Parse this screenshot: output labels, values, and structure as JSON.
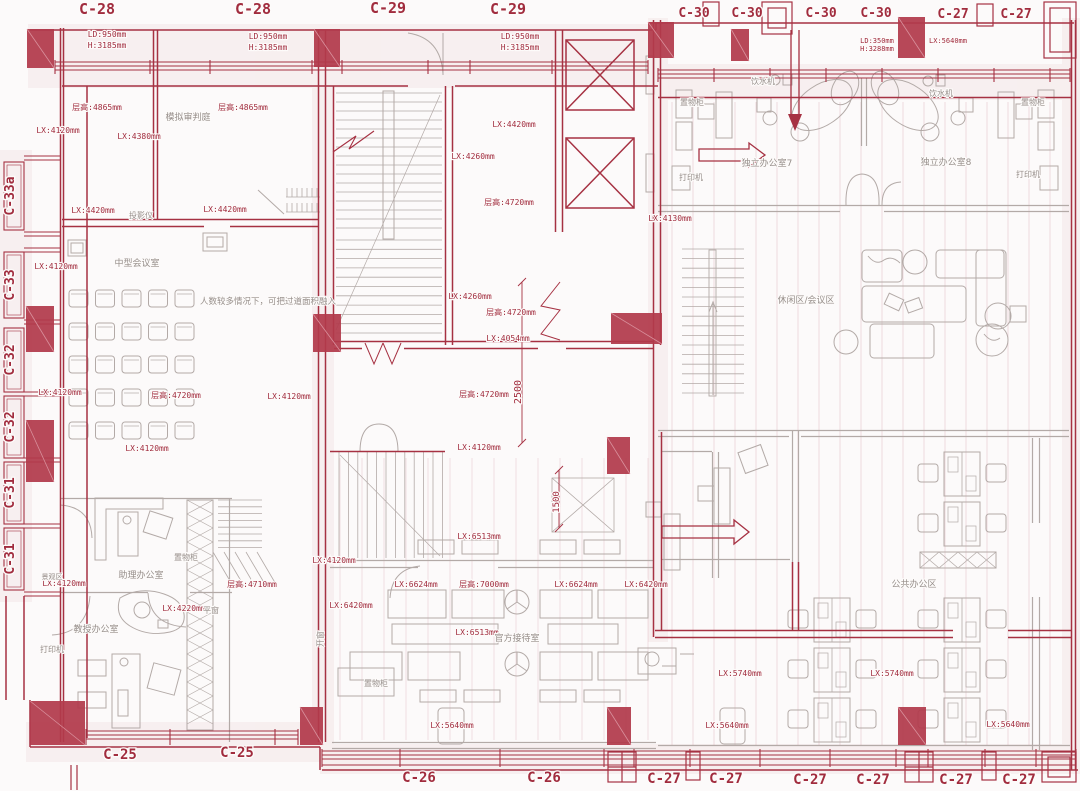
{
  "colors": {
    "wall_red": "#a63142",
    "column_red": "#b23a4b",
    "line_gray": "#b3aaa7",
    "text_gray": "#968e8a",
    "text_red": "#a12c3e",
    "background": "#fcfafa"
  },
  "grid": {
    "top": [
      {
        "label": "C-28",
        "x": 97,
        "y": 14,
        "size": 15
      },
      {
        "label": "C-28",
        "x": 253,
        "y": 14,
        "size": 15
      },
      {
        "label": "C-29",
        "x": 388,
        "y": 13,
        "size": 15
      },
      {
        "label": "C-29",
        "x": 508,
        "y": 14,
        "size": 15
      },
      {
        "label": "C-30",
        "x": 694,
        "y": 17,
        "size": 13
      },
      {
        "label": "C-30",
        "x": 747,
        "y": 17,
        "size": 13
      },
      {
        "label": "C-30",
        "x": 821,
        "y": 17,
        "size": 13
      },
      {
        "label": "C-30",
        "x": 876,
        "y": 17,
        "size": 13
      },
      {
        "label": "C-27",
        "x": 953,
        "y": 18,
        "size": 13
      },
      {
        "label": "C-27",
        "x": 1016,
        "y": 18,
        "size": 13
      }
    ],
    "left": [
      {
        "label": "C-33a",
        "x": 14,
        "y": 196
      },
      {
        "label": "C-33",
        "x": 14,
        "y": 285
      },
      {
        "label": "C-32",
        "x": 14,
        "y": 360
      },
      {
        "label": "C-32",
        "x": 14,
        "y": 427
      },
      {
        "label": "C-31",
        "x": 14,
        "y": 493
      },
      {
        "label": "C-31",
        "x": 14,
        "y": 559
      }
    ],
    "bottom": [
      {
        "label": "C-25",
        "x": 120,
        "y": 759,
        "size": 14
      },
      {
        "label": "C-25",
        "x": 237,
        "y": 757,
        "size": 14
      },
      {
        "label": "C-26",
        "x": 419,
        "y": 782,
        "size": 14
      },
      {
        "label": "C-26",
        "x": 544,
        "y": 782,
        "size": 14
      },
      {
        "label": "C-27",
        "x": 664,
        "y": 783,
        "size": 14
      },
      {
        "label": "C-27",
        "x": 726,
        "y": 783,
        "size": 14
      },
      {
        "label": "C-27",
        "x": 810,
        "y": 784,
        "size": 14
      },
      {
        "label": "C-27",
        "x": 873,
        "y": 784,
        "size": 14
      },
      {
        "label": "C-27",
        "x": 956,
        "y": 784,
        "size": 14
      },
      {
        "label": "C-27",
        "x": 1019,
        "y": 784,
        "size": 14
      }
    ]
  },
  "dimensions": [
    {
      "text": "LD:950mm",
      "x": 107,
      "y": 37
    },
    {
      "text": "H:3185mm",
      "x": 107,
      "y": 48
    },
    {
      "text": "LD:950mm",
      "x": 268,
      "y": 39
    },
    {
      "text": "H:3185mm",
      "x": 268,
      "y": 50
    },
    {
      "text": "LD:950mm",
      "x": 520,
      "y": 39
    },
    {
      "text": "H:3185mm",
      "x": 520,
      "y": 50
    },
    {
      "text": "LD:350mm",
      "x": 877,
      "y": 43,
      "size": 7
    },
    {
      "text": "H:3288mm",
      "x": 877,
      "y": 51,
      "size": 7
    },
    {
      "text": "LX:5640mm",
      "x": 948,
      "y": 43,
      "size": 7
    },
    {
      "text": "层高:4865mm",
      "x": 97,
      "y": 110
    },
    {
      "text": "层高:4865mm",
      "x": 243,
      "y": 110
    },
    {
      "text": "LX:4120mm",
      "x": 58,
      "y": 133
    },
    {
      "text": "LX:4380mm",
      "x": 139,
      "y": 139
    },
    {
      "text": "LX:4420mm",
      "x": 93,
      "y": 213
    },
    {
      "text": "LX:4420mm",
      "x": 225,
      "y": 212
    },
    {
      "text": "LX:4420mm",
      "x": 514,
      "y": 127
    },
    {
      "text": "LX:4260mm",
      "x": 473,
      "y": 159
    },
    {
      "text": "层高:4720mm",
      "x": 509,
      "y": 205
    },
    {
      "text": "LX:4130mm",
      "x": 670,
      "y": 221
    },
    {
      "text": "LX:4120mm",
      "x": 56,
      "y": 269
    },
    {
      "text": "LX:4260mm",
      "x": 470,
      "y": 299
    },
    {
      "text": "层高:4720mm",
      "x": 511,
      "y": 315
    },
    {
      "text": "LX:4054mm",
      "x": 508,
      "y": 341
    },
    {
      "text": "LX:4120mm",
      "x": 60,
      "y": 395
    },
    {
      "text": "层高:4720mm",
      "x": 176,
      "y": 398
    },
    {
      "text": "LX:4120mm",
      "x": 289,
      "y": 399
    },
    {
      "text": "层高:4720mm",
      "x": 484,
      "y": 397
    },
    {
      "text": "LX:4120mm",
      "x": 147,
      "y": 451
    },
    {
      "text": "LX:4120mm",
      "x": 479,
      "y": 450
    },
    {
      "text": "LX:6513mm",
      "x": 479,
      "y": 539
    },
    {
      "text": "LX:4120mm",
      "x": 64,
      "y": 586
    },
    {
      "text": "层高:4710mm",
      "x": 252,
      "y": 587
    },
    {
      "text": "LX:4220mm",
      "x": 184,
      "y": 611
    },
    {
      "text": "LX:4120mm",
      "x": 334,
      "y": 563
    },
    {
      "text": "LX:6624mm",
      "x": 416,
      "y": 587
    },
    {
      "text": "层高:7000mm",
      "x": 484,
      "y": 587
    },
    {
      "text": "LX:6624mm",
      "x": 576,
      "y": 587
    },
    {
      "text": "LX:6420mm",
      "x": 646,
      "y": 587
    },
    {
      "text": "LX:6420mm",
      "x": 351,
      "y": 608
    },
    {
      "text": "LX:6513mm",
      "x": 477,
      "y": 635
    },
    {
      "text": "LX:5740mm",
      "x": 740,
      "y": 676
    },
    {
      "text": "LX:5740mm",
      "x": 892,
      "y": 676
    },
    {
      "text": "LX:5640mm",
      "x": 452,
      "y": 728
    },
    {
      "text": "LX:5640mm",
      "x": 727,
      "y": 728
    },
    {
      "text": "LX:5640mm",
      "x": 1008,
      "y": 727
    },
    {
      "text": "2500",
      "x": 521,
      "y": 392,
      "rot": -90,
      "size": 10
    },
    {
      "text": "1500",
      "x": 559,
      "y": 502,
      "rot": -90,
      "size": 9
    }
  ],
  "rooms": [
    {
      "text": "模拟审判庭",
      "x": 188,
      "y": 120
    },
    {
      "text": "投影仪",
      "x": 141,
      "y": 218,
      "size": 8
    },
    {
      "text": "中型会议室",
      "x": 137,
      "y": 266
    },
    {
      "text": "人数较多情况下，可把过道面积融入",
      "x": 268,
      "y": 304,
      "size": 8.5
    },
    {
      "text": "饮水机",
      "x": 763,
      "y": 84,
      "size": 8
    },
    {
      "text": "饮水机",
      "x": 941,
      "y": 96,
      "size": 8
    },
    {
      "text": "置物柜",
      "x": 692,
      "y": 105,
      "size": 8
    },
    {
      "text": "置物柜",
      "x": 1033,
      "y": 105,
      "size": 8
    },
    {
      "text": "独立办公室7",
      "x": 767,
      "y": 166
    },
    {
      "text": "独立办公室8",
      "x": 946,
      "y": 165
    },
    {
      "text": "打印机",
      "x": 691,
      "y": 180,
      "size": 8
    },
    {
      "text": "打印机",
      "x": 1028,
      "y": 177,
      "size": 8
    },
    {
      "text": "休闲区/会议区",
      "x": 806,
      "y": 303
    },
    {
      "text": "助理办公室",
      "x": 141,
      "y": 578
    },
    {
      "text": "置物柜",
      "x": 186,
      "y": 560,
      "size": 8
    },
    {
      "text": "景观区",
      "x": 52,
      "y": 579,
      "size": 7
    },
    {
      "text": "平窗",
      "x": 211,
      "y": 613,
      "size": 8
    },
    {
      "text": "教授办公室",
      "x": 96,
      "y": 632
    },
    {
      "text": "打印机",
      "x": 52,
      "y": 652,
      "size": 8
    },
    {
      "text": "官方接待室",
      "x": 517,
      "y": 641
    },
    {
      "text": "置物柜",
      "x": 376,
      "y": 686,
      "size": 8
    },
    {
      "text": "公共办公区",
      "x": 914,
      "y": 587
    },
    {
      "text": "开窗",
      "x": 323,
      "y": 639,
      "size": 8,
      "rot": -90
    }
  ]
}
